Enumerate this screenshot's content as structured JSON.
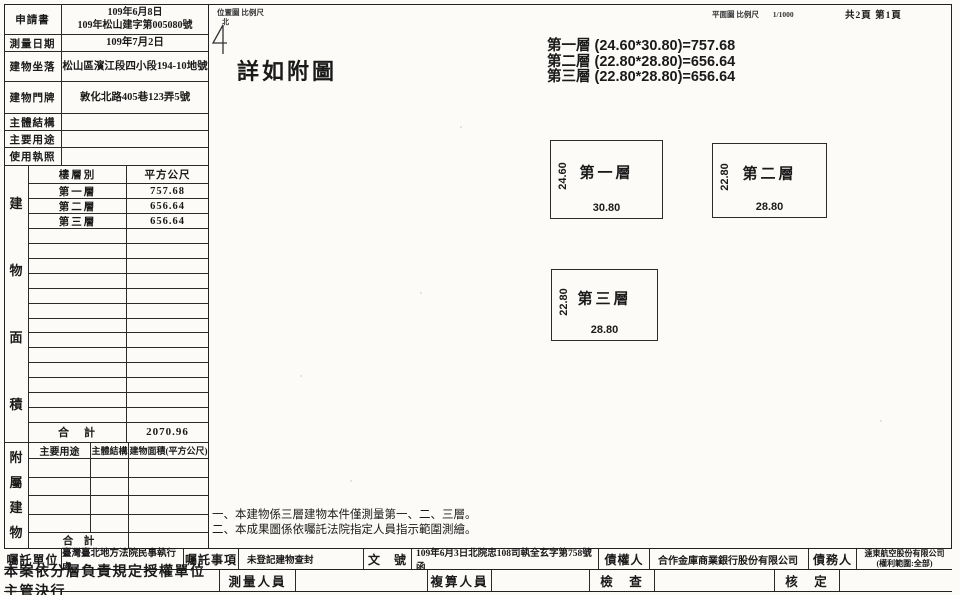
{
  "colors": {
    "ink": "#1a1a1a",
    "paper": "#fcfbf8"
  },
  "header_table": {
    "rows": [
      {
        "label": "申請書",
        "value": "109年6月8日\n109年松山建字第005080號"
      },
      {
        "label": "測量日期",
        "value": "109年7月2日"
      },
      {
        "label": "建物坐落",
        "value": "松山區濱江段四小段194-10地號"
      },
      {
        "label": "建物門牌",
        "value": "敦化北路405巷123弄5號"
      },
      {
        "label": "主體結構",
        "value": ""
      },
      {
        "label": "主要用途",
        "value": ""
      },
      {
        "label": "使用執照",
        "value": ""
      }
    ]
  },
  "area_table": {
    "side_label": "建物面積",
    "col_floor": "樓層別",
    "col_area": "平方公尺",
    "rows": [
      {
        "floor": "第一層",
        "area": "757.68"
      },
      {
        "floor": "第二層",
        "area": "656.64"
      },
      {
        "floor": "第三層",
        "area": "656.64"
      }
    ],
    "total_label": "合　計",
    "total_value": "2070.96"
  },
  "annex_table": {
    "side_label": "附屬建物",
    "headers": [
      "主要用途",
      "主體結構",
      "建物面積(平方公尺)"
    ],
    "total_label": "合　計",
    "total_value": ""
  },
  "drawing": {
    "location_map_label": "位置圖 比例尺",
    "north_label": "北",
    "plan_label": "平面圖 比例尺",
    "plan_scale": "1/1000",
    "page_label": "共2頁 第1頁",
    "see_attached": "詳如附圖",
    "formulas": [
      "第一層 (24.60*30.80)=757.68",
      "第二層 (22.80*28.80)=656.64",
      "第三層 (22.80*28.80)=656.64"
    ],
    "floors": [
      {
        "name": "第一層",
        "height_label": "24.60",
        "width_label": "30.80"
      },
      {
        "name": "第二層",
        "height_label": "22.80",
        "width_label": "28.80"
      },
      {
        "name": "第三層",
        "height_label": "22.80",
        "width_label": "28.80"
      }
    ],
    "notes": [
      "一、本建物係三層建物本件僅測量第一、二、三層。",
      "二、本成果圖係依囑託法院指定人員指示範圍測繪。"
    ]
  },
  "footer": {
    "row1": [
      {
        "label": "囑託單位",
        "value": "臺灣臺北地方法院民事執行處"
      },
      {
        "label": "囑託事項",
        "value": "未登記建物查封"
      },
      {
        "label": "文　號",
        "value": "109年6月3日北院忠108司執全玄字第758號函"
      },
      {
        "label": "債權人",
        "value": "合作金庫商業銀行股份有限公司"
      },
      {
        "label": "債務人",
        "value": "遠東航空股份有限公司\n(權利範圍:全部)"
      }
    ],
    "row2": {
      "approval": "本案依分層負責規定授權單位主管決行",
      "surveyor_label": "測量人員",
      "surveyor_value": "",
      "checker_label": "複算人員",
      "checker_value": "",
      "inspect_label": "檢　查",
      "inspect_value": "",
      "approve_label": "核　定",
      "approve_value": ""
    }
  }
}
